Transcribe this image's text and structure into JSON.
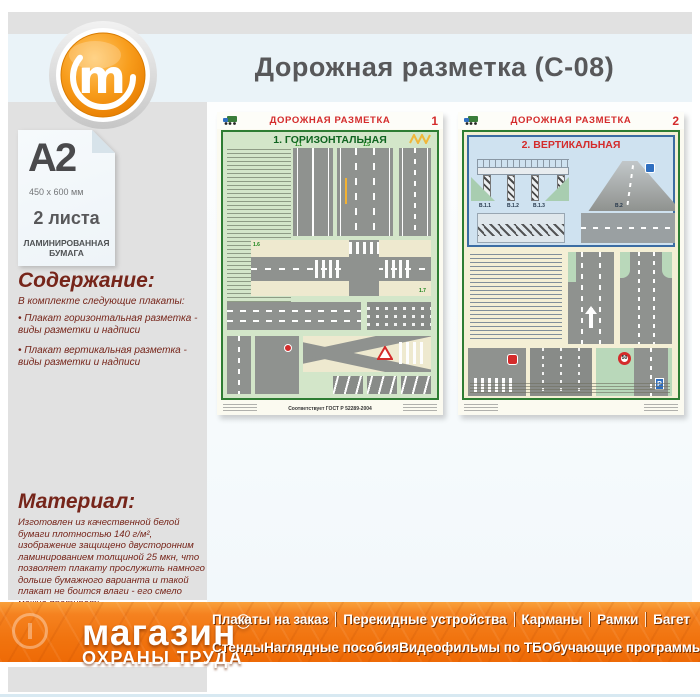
{
  "header": {
    "title": "Дорожная разметка (С-08)"
  },
  "logo": {
    "letter": "m"
  },
  "product": {
    "format": "A2",
    "size": "450 x 600 мм",
    "sheets": "2 листа",
    "paper": "ЛАМИНИРОВАННАЯ\nБУМАГА"
  },
  "contents": {
    "heading": "Содержание:",
    "intro": "В комплекте следующие плакаты:",
    "bullets": [
      "• Плакат горизонтальная разметка - виды разметки и надписи",
      "• Плакат вертикальная разметка - виды разметки и надписи"
    ]
  },
  "material": {
    "heading": "Материал:",
    "text": "Изготовлен из качественной белой бумаги плотностью 140 г/м², изображение защищено двусторонним ламинированием толщиной 25 мкн, что позволяет плакату прослужить намного дольше бумажного варианта и такой плакат не боится влаги - его смело можно протирать."
  },
  "posters": {
    "left": {
      "header": "ДОРОЖНАЯ РАЗМЕТКА",
      "number": "1",
      "section_title": "1. ГОРИЗОНТАЛЬНАЯ",
      "gost": "Соответствует ГОСТ Р 52289-2004",
      "labels": [
        "1.1",
        "1.5",
        "1.6",
        "1.7"
      ]
    },
    "right": {
      "header": "ДОРОЖНАЯ РАЗМЕТКА",
      "number": "2",
      "section_title": "2. ВЕРТИКАЛЬНАЯ",
      "labels": [
        "В.1.1",
        "В.1.2",
        "В.1.3",
        "В.2"
      ],
      "signs": {
        "speed_limit": "50",
        "parking": "Р"
      }
    }
  },
  "footer": {
    "brand_line1": "магазин",
    "brand_mark": "ⓜ",
    "brand_line2": "ОХРАНЫ ТРУДА",
    "menu_row1": [
      "Плакаты на заказ",
      "Перекидные устройства",
      "Карманы",
      "Рамки",
      "Багет"
    ],
    "menu_row2": [
      "Стенды",
      "Наглядные пособия",
      "Видеофильмы по ТБ",
      "Обучающие программы"
    ]
  }
}
